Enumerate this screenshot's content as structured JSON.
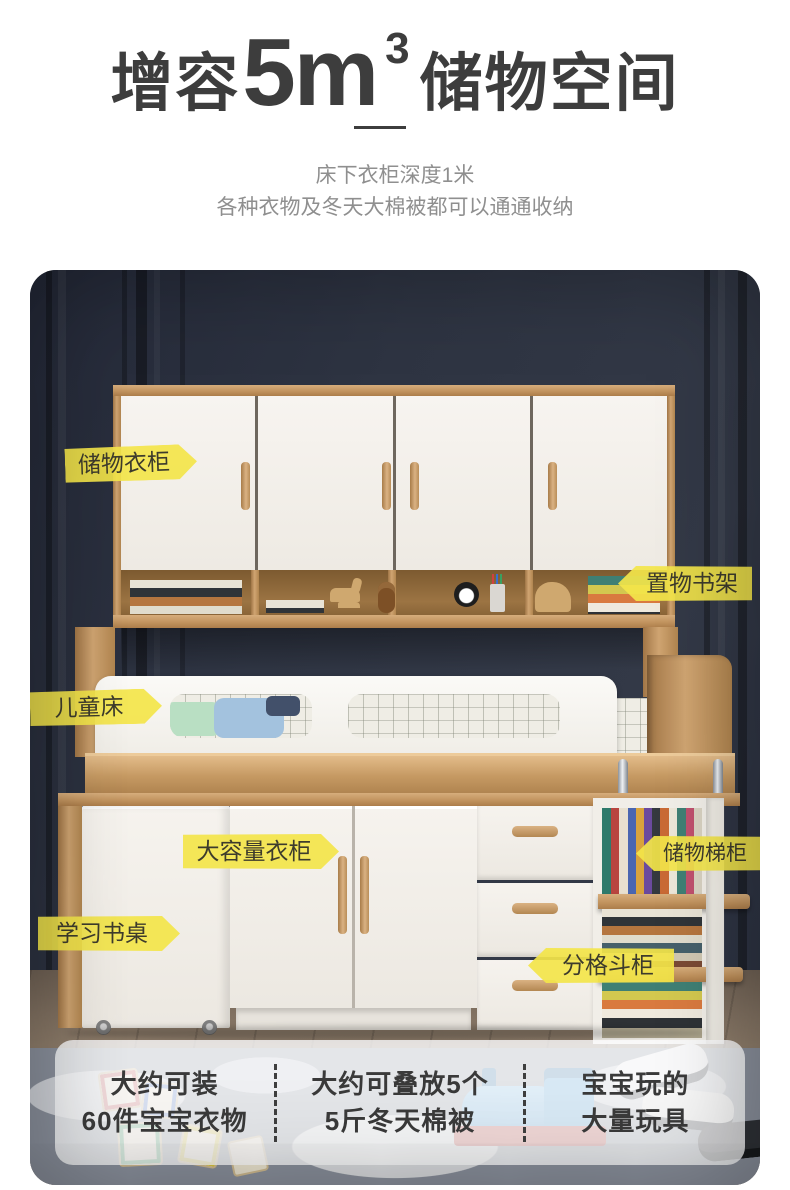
{
  "header": {
    "title": {
      "prefix": "增容",
      "big": "5m",
      "sup": "3",
      "suffix": "储物空间"
    },
    "subtitle_line1": "床下衣柜深度1米",
    "subtitle_line2": "各种衣物及冬天大棉被都可以通通收纳"
  },
  "product_labels": {
    "storage_wardrobe": "储物衣柜",
    "display_shelf": "置物书架",
    "kids_bed": "儿童床",
    "large_wardrobe": "大容量衣柜",
    "study_desk": "学习书桌",
    "storage_ladder_cabinet": "储物梯柜",
    "compartment_drawer": "分格斗柜"
  },
  "capacity_stats": [
    {
      "line1": "大约可装",
      "line2": "60件宝宝衣物"
    },
    {
      "line1": "大约可叠放5个",
      "line2": "5斤冬天棉被"
    },
    {
      "line1": "宝宝玩的",
      "line2": "大量玩具"
    }
  ],
  "colors": {
    "accent_yellow": "#F3E54A",
    "wall_navy": "#2F3443",
    "wood": "#C69A68",
    "title_text": "#3D3D3D",
    "subtitle_text": "#8F8F8F"
  }
}
